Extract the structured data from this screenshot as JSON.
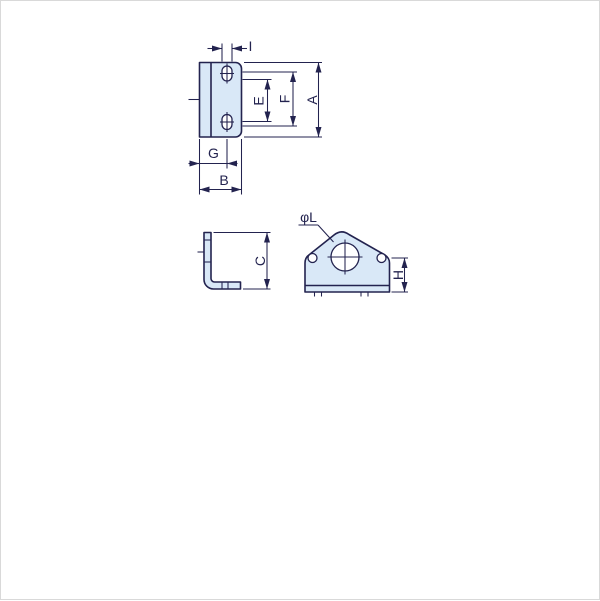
{
  "drawing": {
    "type": "engineering-drawing",
    "views": {
      "top_view": {
        "dim_labels": {
          "slot_width": "I",
          "slot_inner_span": "E",
          "slot_outer_span": "F",
          "overall_height": "A",
          "edge_to_slot_center": "G",
          "overall_width": "B"
        }
      },
      "side_view": {
        "dim_labels": {
          "leg_height": "C"
        }
      },
      "front_view": {
        "dim_labels": {
          "center_hole_diameter": "φL",
          "hole_center_height": "H"
        }
      }
    }
  },
  "colors": {
    "line": "#23234f",
    "part-fill": "#d9e8f7",
    "hole-fill": "#ffffff",
    "frame": "#d9d9d9",
    "background": "#ffffff"
  }
}
